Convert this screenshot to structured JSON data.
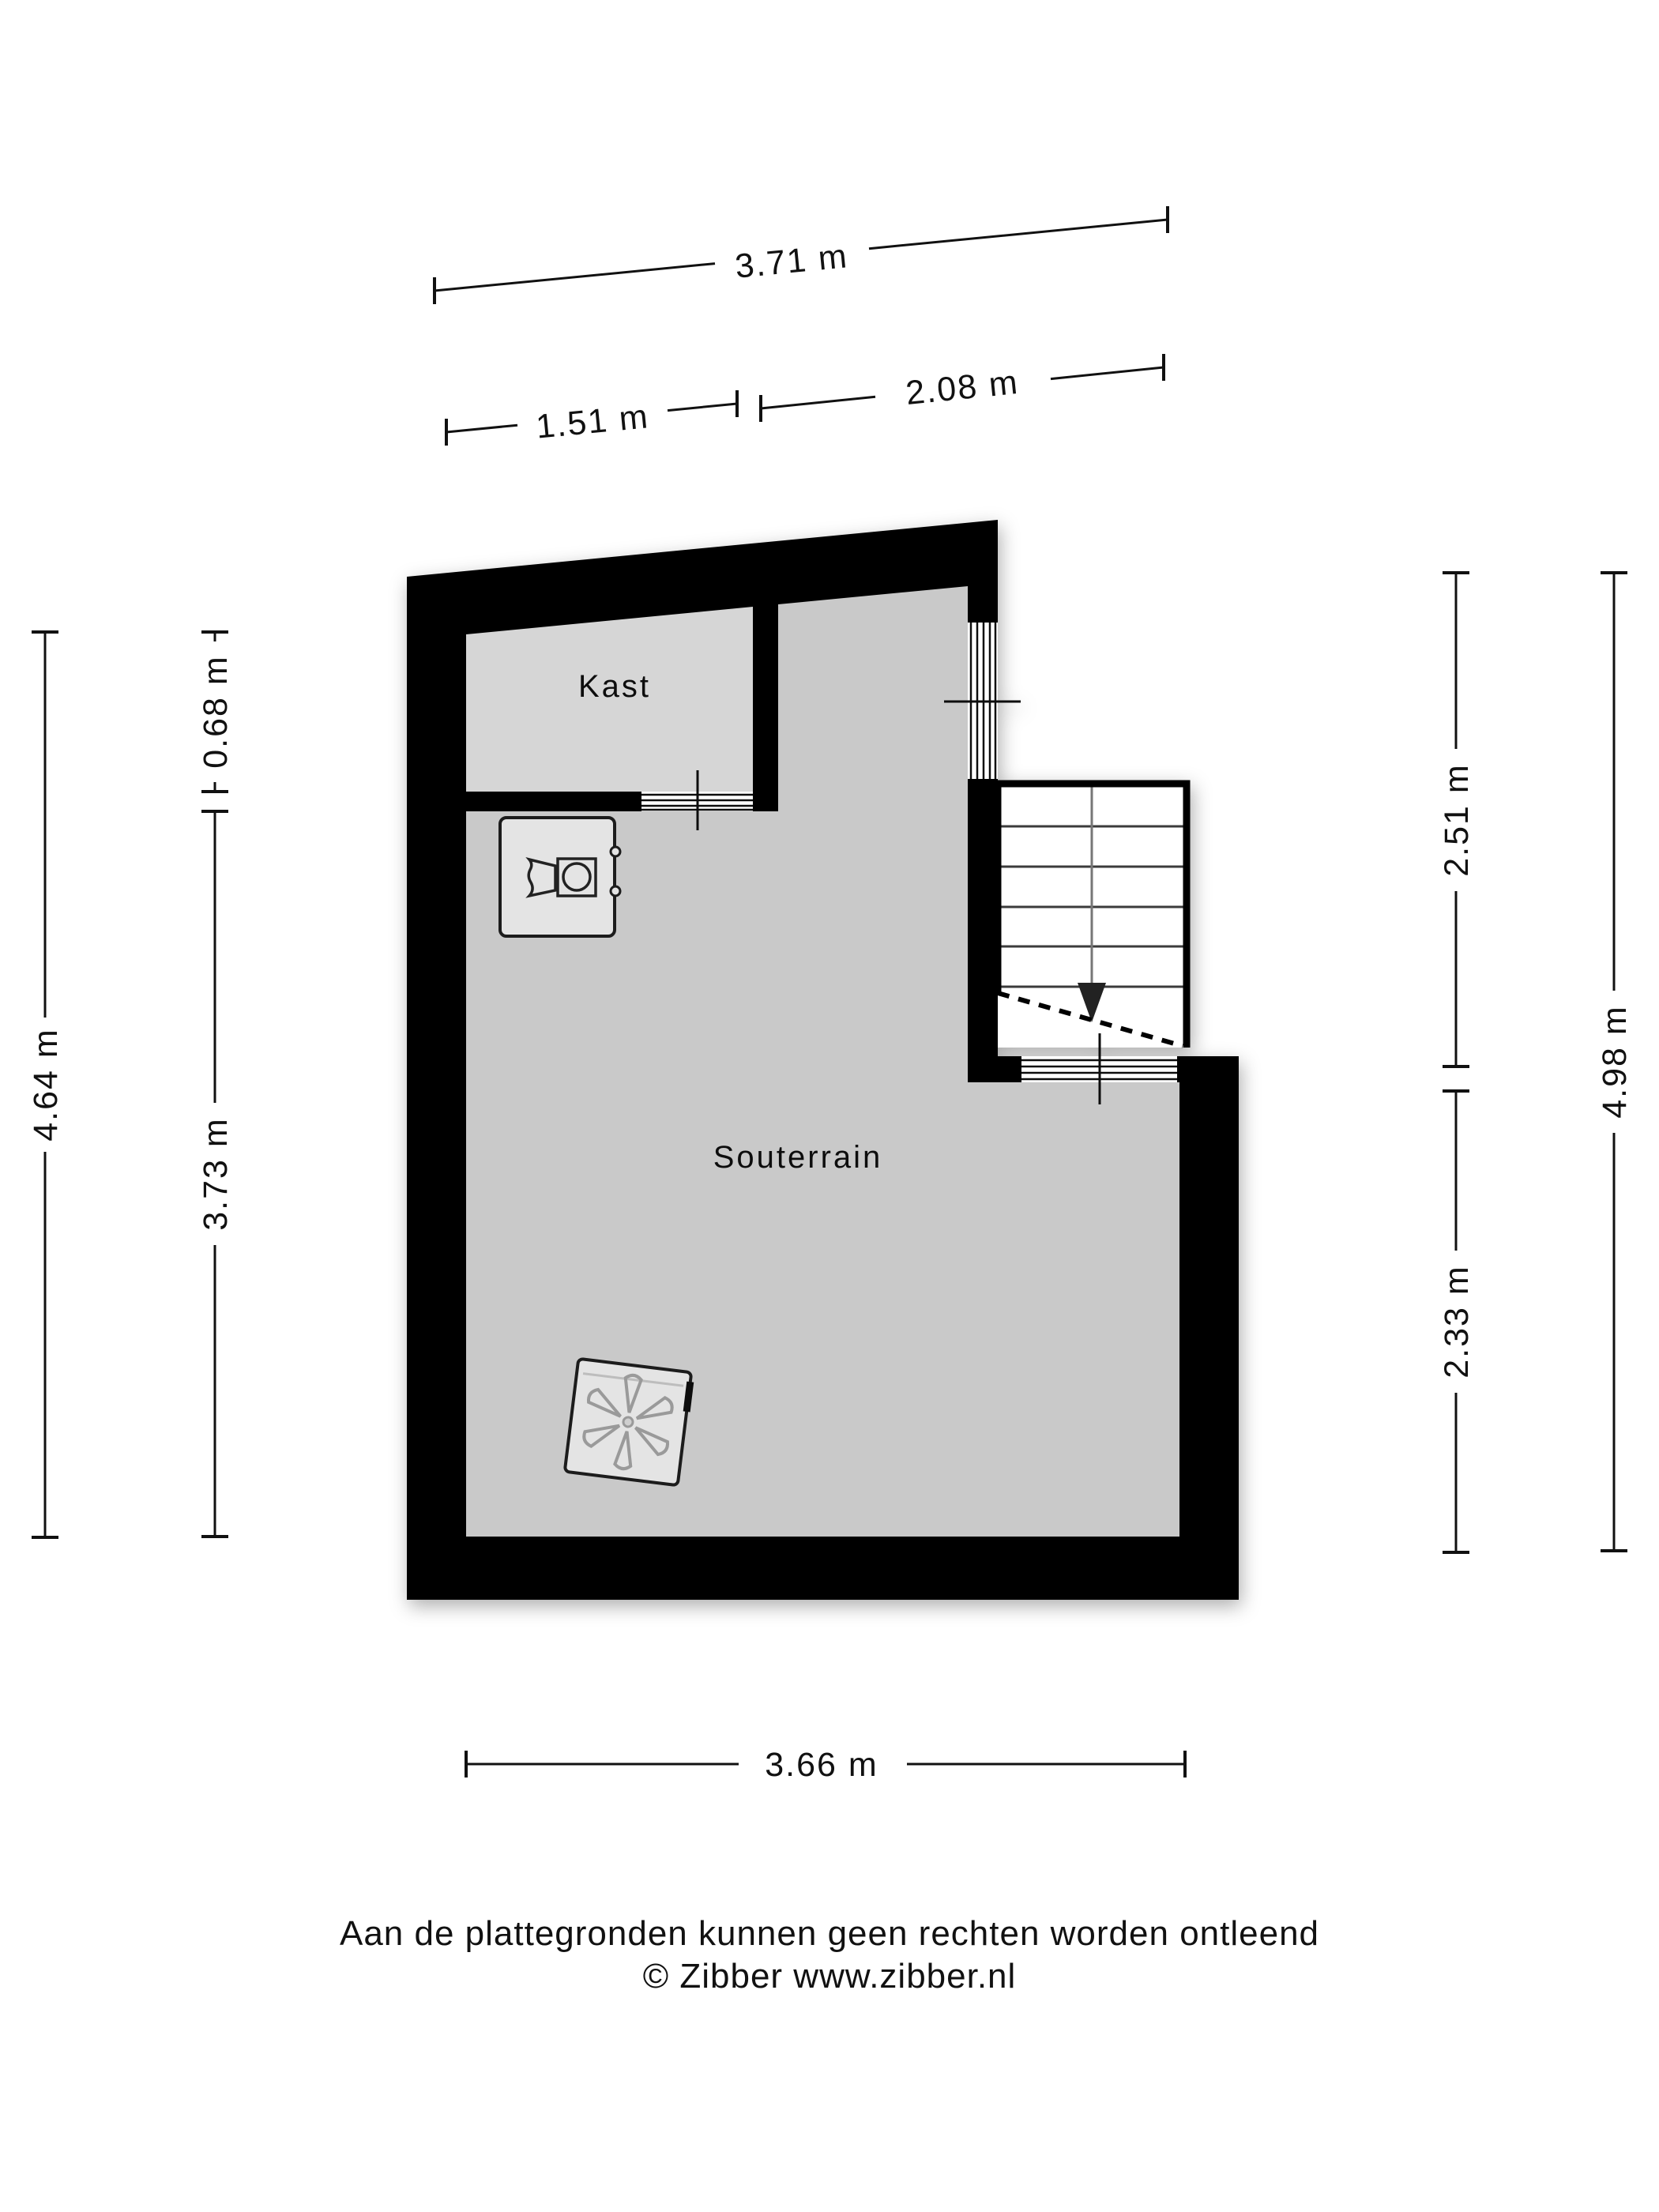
{
  "plan": {
    "type": "floorplan",
    "floor_name": "Souterrain",
    "rooms": [
      {
        "name": "Kast"
      },
      {
        "name": "Souterrain"
      }
    ]
  },
  "labels": {
    "kast": "Kast",
    "souterrain": "Souterrain"
  },
  "dimensions": {
    "top": [
      {
        "label": "3.71 m"
      },
      {
        "label": "1.51 m"
      },
      {
        "label": "2.08 m"
      }
    ],
    "left": [
      {
        "label": "4.64 m"
      },
      {
        "label": "0.68 m"
      },
      {
        "label": "3.73 m"
      }
    ],
    "right": [
      {
        "label": "2.51 m"
      },
      {
        "label": "4.98 m"
      },
      {
        "label": "2.33 m"
      }
    ],
    "bottom": [
      {
        "label": "3.66 m"
      }
    ]
  },
  "footer": {
    "disclaimer": "Aan de plattegronden kunnen geen rechten worden ontleend",
    "copyright": "© Zibber www.zibber.nl"
  },
  "icons": {
    "washer": "washing-machine-icon",
    "ventilation": "ventilation-fan-icon",
    "stairs_arrow": "stairs-down-arrow-icon"
  },
  "colors": {
    "background": "#ffffff",
    "wall": "#000000",
    "floor_main": "#c9c9c9",
    "floor_kast": "#d6d6d6",
    "appliance_fill": "#e4e4e4",
    "stairs_fill": "#ffffff",
    "text": "#111111"
  }
}
